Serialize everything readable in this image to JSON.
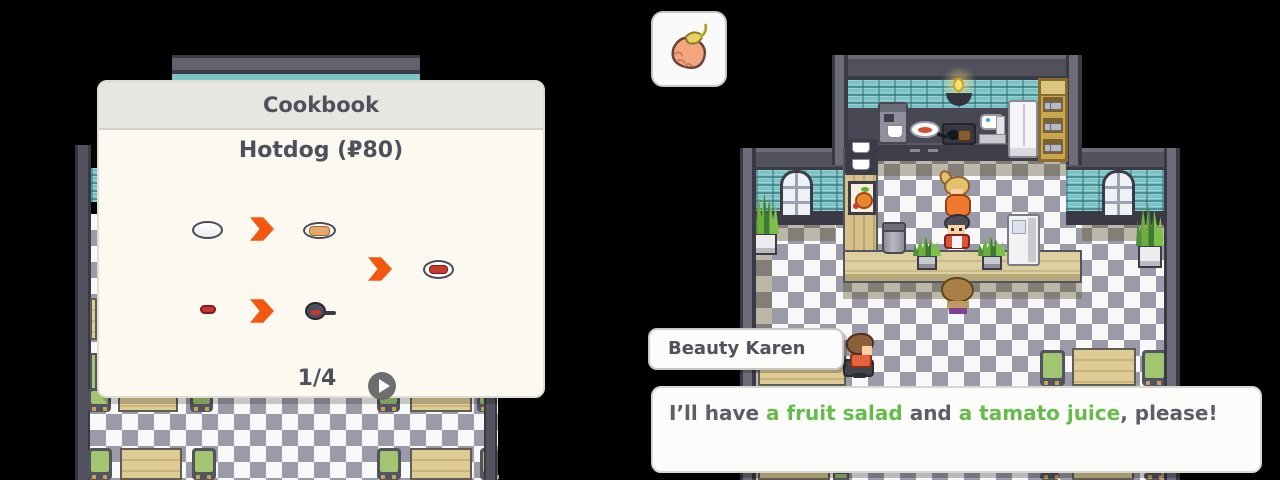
{
  "cookbook": {
    "title": "Cookbook",
    "recipe_title": "Hotdog (₽80)",
    "pagination": "1/4",
    "icons": [
      "dough",
      "arrow-right",
      "bun-on-plate",
      "arrow-right",
      "hotdog-on-plate",
      "sausage",
      "arrow-right",
      "sausage-in-pan"
    ],
    "next_button": "play-icon"
  },
  "hud": {
    "item_icon": "berry"
  },
  "nametag": {
    "label": "Beauty Karen"
  },
  "dialog": {
    "segments": [
      {
        "text": "I’ll have ",
        "color": "dark"
      },
      {
        "text": "a fruit salad",
        "color": "green"
      },
      {
        "text": " and ",
        "color": "dark"
      },
      {
        "text": "a tamato juice",
        "color": "green"
      },
      {
        "text": ", please!",
        "color": "dark"
      }
    ]
  },
  "colors": {
    "accent_orange": "#f4570f",
    "text_dark": "#5d5d68",
    "text_green": "#67bb4d",
    "teal_wall": "#7cc3c6",
    "floor_gray": "#9b9aa9",
    "panel_bg": "#fbf9f0",
    "header_bg": "#e7e6e1"
  }
}
